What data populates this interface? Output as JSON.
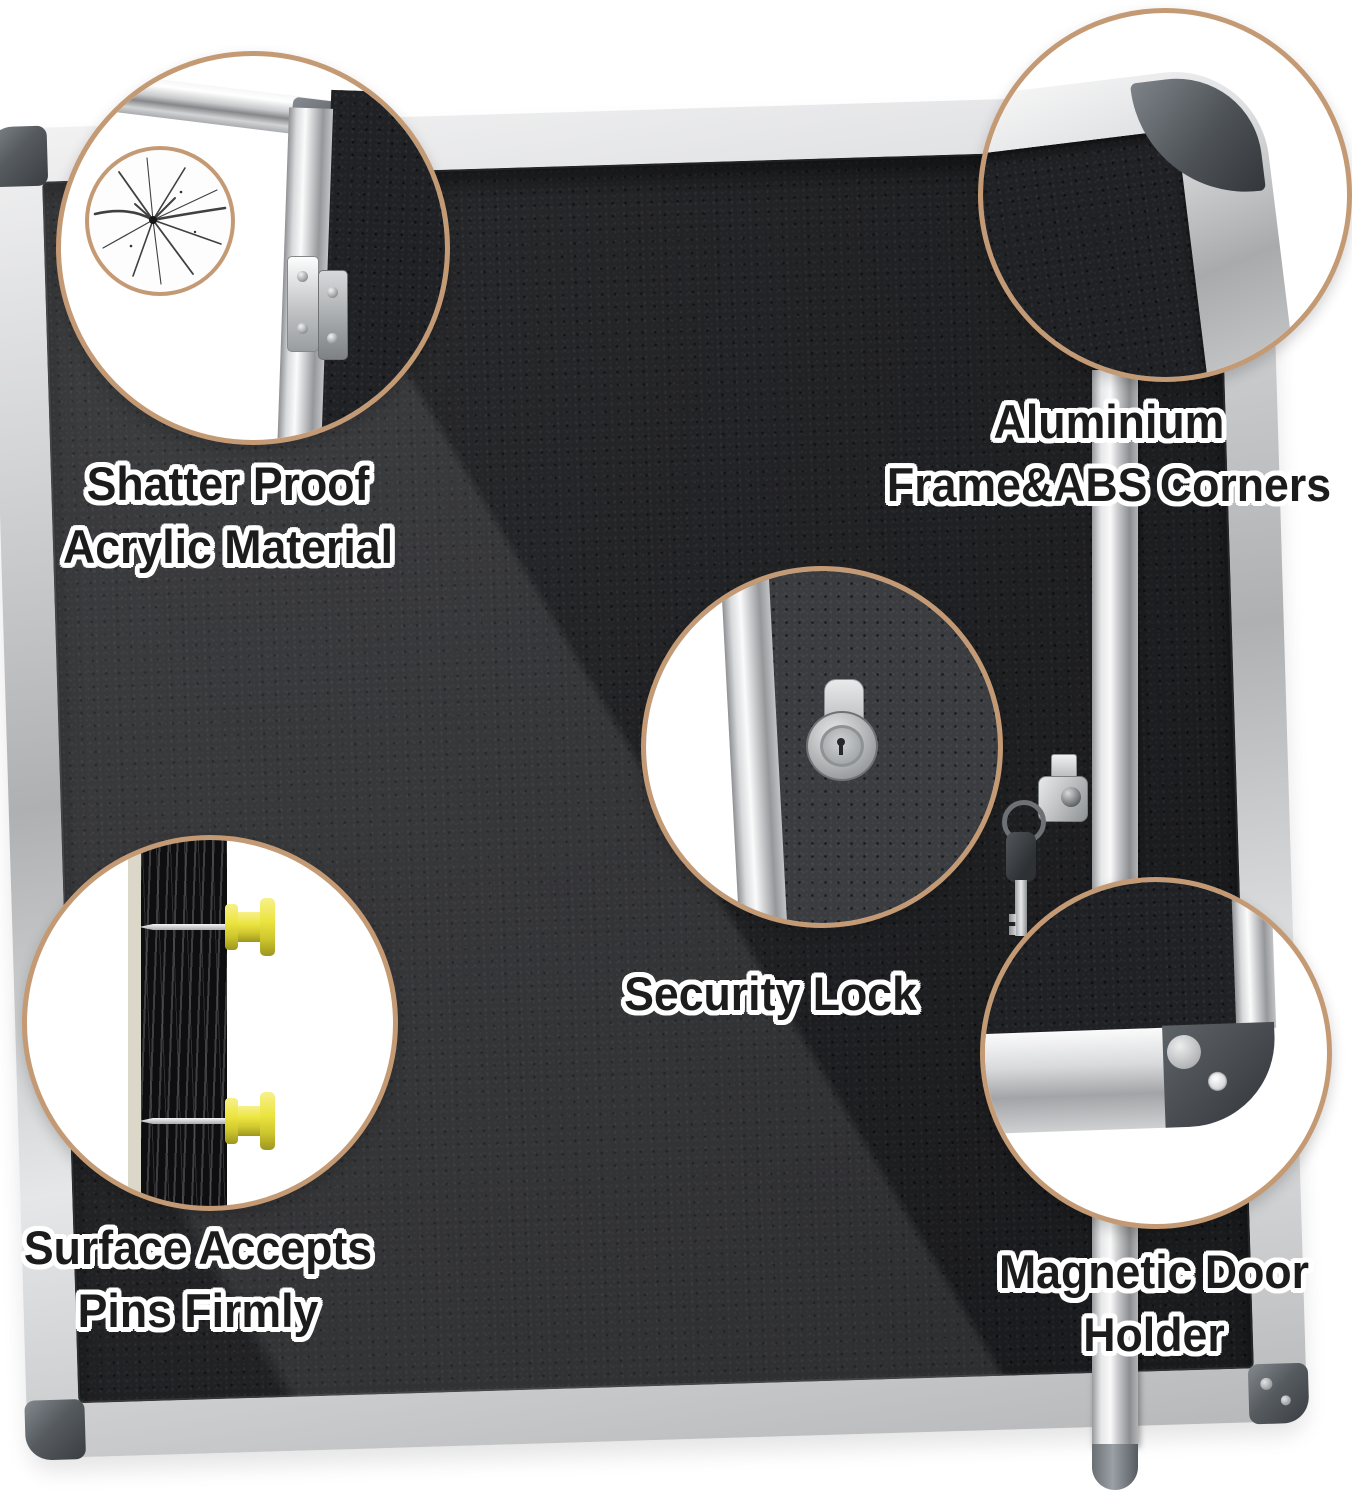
{
  "colors": {
    "background": "#ffffff",
    "accent_ring": "#c49a74",
    "felt_black": "#202124",
    "frame_silver": "#d9dadc",
    "abs_corner_gray": "#53585d",
    "pin_yellow": "#ece43f"
  },
  "callouts": {
    "shatter": {
      "icon": "cracked-glass-icon",
      "lines": [
        "Shatter Proof",
        "Acrylic Material"
      ]
    },
    "corners": {
      "icon": "rounded-corner-icon",
      "lines": [
        "Aluminium",
        "Frame&ABS Corners"
      ]
    },
    "lock": {
      "icon": "cam-lock-icon",
      "lines": [
        "Security Lock"
      ]
    },
    "pins": {
      "icon": "push-pin-icon",
      "lines": [
        "Surface Accepts",
        "Pins Firmly"
      ]
    },
    "magnet": {
      "icon": "magnet-corner-icon",
      "lines": [
        "Magnetic Door",
        "Holder"
      ]
    }
  }
}
